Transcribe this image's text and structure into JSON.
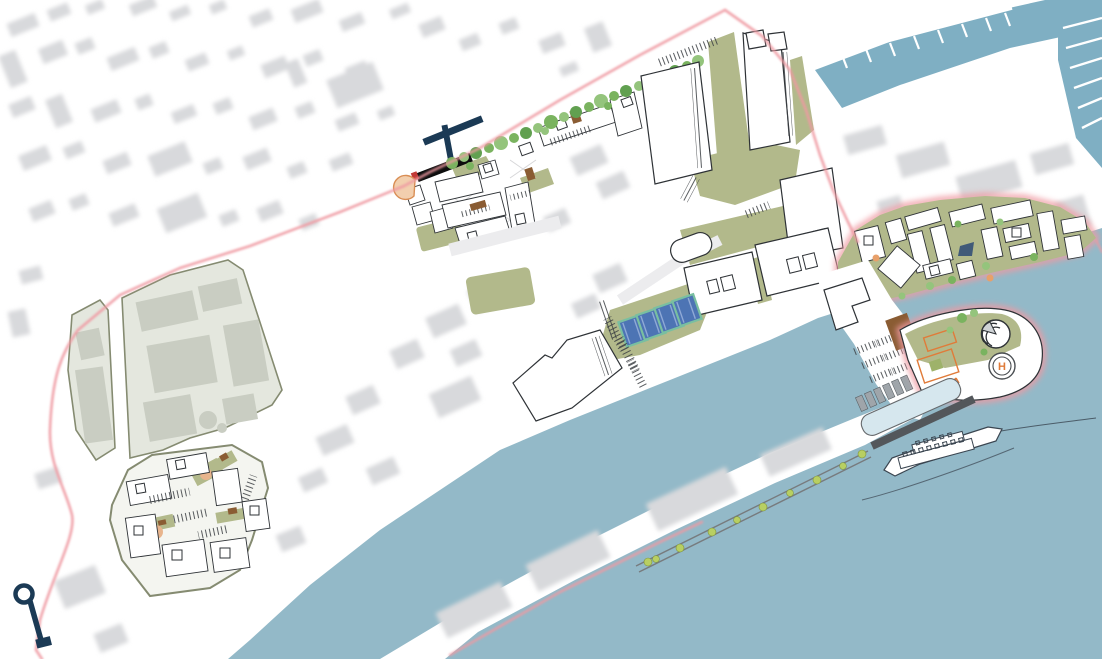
{
  "map": {
    "type": "architectural-site-plan",
    "helipad": {
      "label": "H"
    },
    "features": [
      "context-city-fabric",
      "marina-docks",
      "tree-lined-promenade",
      "north-halls",
      "pool-terrace",
      "waterfront-hall",
      "canal",
      "pier-warehouses",
      "boardwalk-promenade",
      "east-village",
      "harbor-quay",
      "boat-racks",
      "peninsula-park",
      "shell-pavilion",
      "helipad",
      "slipway-basin",
      "cruise-ship",
      "site-boundary",
      "left-parcels",
      "courtyard-block",
      "key-landmark-icon",
      "black-jetty",
      "amphitheater",
      "navy-pier"
    ]
  },
  "palette": {
    "water": "#93b9c8",
    "marina-water": "#7fafc3",
    "context-gray": "#d8d9dc",
    "boundary-pink": "#ef9aa2",
    "site-green": "#b2b98b",
    "tree-green": "#7ab35f",
    "tree-green-2": "#94c47c",
    "tree-green-3": "#61a050",
    "bush-green": "#b8cf62",
    "navy": "#1b3a55",
    "deck-brown": "#8a5c33",
    "pool-water": "#4d74b4",
    "pool-frame": "#79bfa1",
    "orange-accent": "#e07b39",
    "parcel-fill": "#e4e7de",
    "parcel-inner": "#c9cdc2",
    "parcel-stroke": "#858b71",
    "outline-dark": "#2e3236",
    "slipway-fill": "#d6e7ee",
    "dark-band": "#53575b",
    "boat-gray": "#9fa5aa",
    "ship-outline": "#3a4550"
  }
}
